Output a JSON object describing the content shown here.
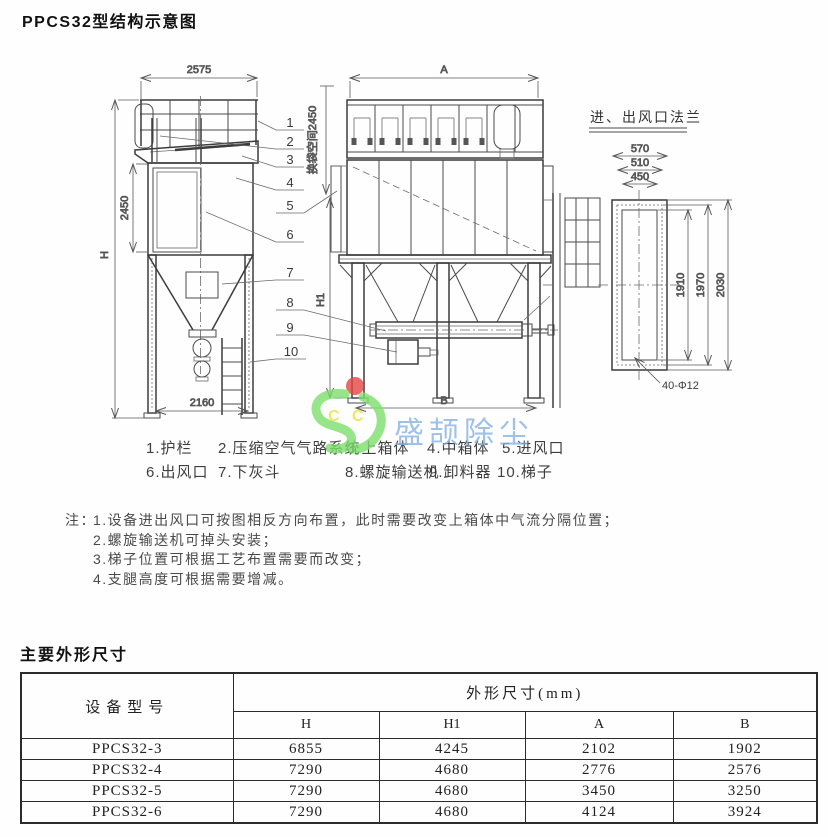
{
  "page": {
    "title": "PPCS32型结构示意图"
  },
  "drawing": {
    "left_view": {
      "dim_width": "2575",
      "dim_mid_height": "2450",
      "dim_total_height": "H",
      "dim_base": "2160"
    },
    "front_view": {
      "dim_width": "A",
      "dim_height": "H1",
      "dim_base": "B",
      "dim_bag_space": "换袋空间2450"
    },
    "flange_detail": {
      "title": "进、出风口法兰",
      "dim_w_outer": "570",
      "dim_w_mid": "510",
      "dim_w_inner": "450",
      "dim_h_inner": "1910",
      "dim_h_mid": "1970",
      "dim_h_outer": "2030",
      "dim_holes": "40-Φ12"
    },
    "callouts": [
      "1",
      "2",
      "3",
      "4",
      "5",
      "6",
      "7",
      "8",
      "9",
      "10"
    ]
  },
  "legend": {
    "items": [
      "1.护栏",
      "2.压缩空气气路系统",
      "3.上箱体",
      "4.中箱体",
      "5.进风口",
      "6.出风口",
      "7.下灰斗",
      "8.螺旋输送机",
      "9.卸料器",
      "10.梯子"
    ]
  },
  "notes": {
    "prefix": "注：",
    "items": [
      "1.设备进出风口可按图相反方向布置，此时需要改变上箱体中气流分隔位置；",
      "2.螺旋输送机可掉头安装；",
      "3.梯子位置可根据工艺布置需要而改变；",
      "4.支腿高度可根据需要增减。"
    ]
  },
  "dimensions_section": {
    "title": "主要外形尺寸",
    "table": {
      "col_model": "设备型号",
      "col_group": "外形尺寸(mm)",
      "sub_columns": [
        "H",
        "H1",
        "A",
        "B"
      ],
      "rows": [
        {
          "model": "PPCS32-3",
          "values": [
            "6855",
            "4245",
            "2102",
            "1902"
          ]
        },
        {
          "model": "PPCS32-4",
          "values": [
            "7290",
            "4680",
            "2776",
            "2576"
          ]
        },
        {
          "model": "PPCS32-5",
          "values": [
            "7290",
            "4680",
            "3450",
            "3250"
          ]
        },
        {
          "model": "PPCS32-6",
          "values": [
            "7290",
            "4680",
            "4124",
            "3924"
          ]
        }
      ]
    }
  },
  "watermark": {
    "company": "盛颉除尘",
    "letters": [
      "C",
      "C"
    ],
    "colors": {
      "logo_green": "#7de06c",
      "dot_red": "#e64545",
      "letter_yellow": "#efdf3a",
      "text_blue": "#86b2e2"
    }
  }
}
